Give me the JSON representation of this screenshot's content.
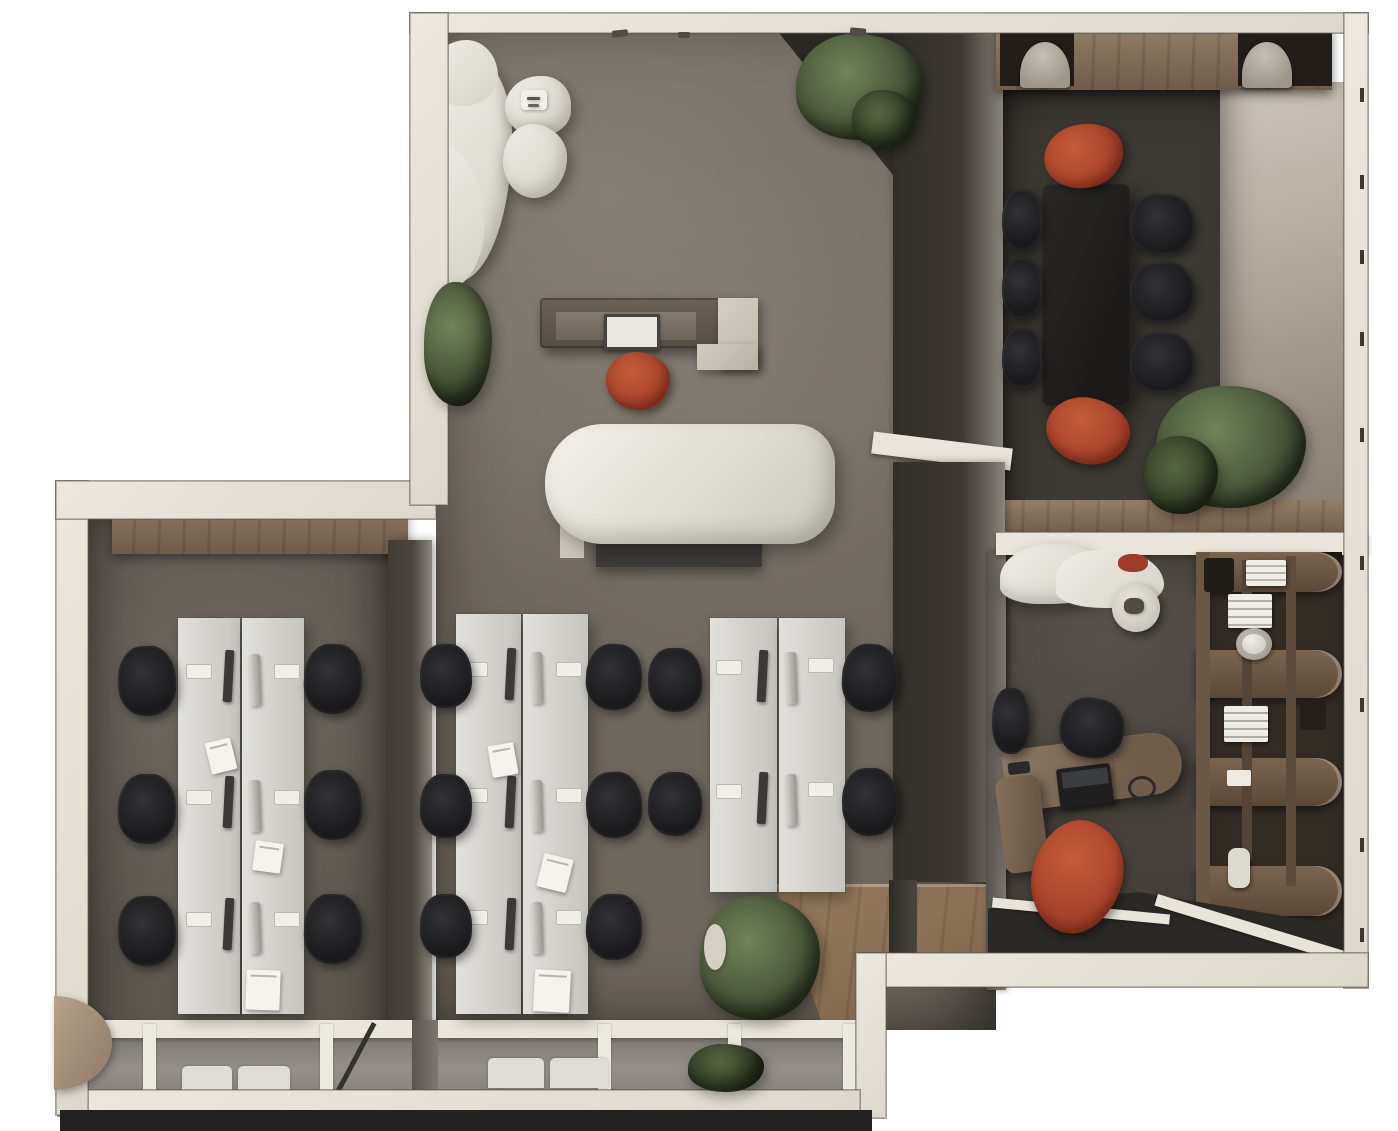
{
  "meta": {
    "description": "Top-down 3D architectural render of an office interior floor plan",
    "render_style": "photorealistic top view, no visible text or UI chrome"
  },
  "palette": {
    "outside": "#ffffff",
    "outerWall": "#e9e5da",
    "outerWallEdge": "#7b776f",
    "innerWallDark": "#38342e",
    "floorOpen": "#6e675e",
    "floorLeftRoom": "#5e5850",
    "floorMeeting": "#3d3933",
    "floorExec": "#46413a",
    "concreteWall": "#b4aa9c",
    "woodCredenza": "#8a7560",
    "woodFloor": "#8b7154",
    "deskWhite": "#d9d7d2",
    "chairBlack": "#1d1d1f",
    "chairRust": "#b0492f",
    "sofaCream": "#e5e2da",
    "conferenceTable": "#232221",
    "plantGreen": "#4c593a",
    "glassGray": "#8e8a83",
    "baseStrip": "#212121"
  },
  "rooms": [
    {
      "id": "reception-lounge",
      "label": "Reception and lounge",
      "furniture": [
        "organic-sofa",
        "pouf-side-tables",
        "reception-desk",
        "desktop-monitor",
        "rust-task-chair",
        "waiting-bench",
        "potted-plant",
        "coat-hooks"
      ]
    },
    {
      "id": "team-room-left",
      "label": "Enclosed team room",
      "workstations": 6,
      "furniture": [
        "double-desk-row",
        "task-chairs",
        "wood-credenza",
        "glazed-facade"
      ]
    },
    {
      "id": "open-office-center",
      "label": "Open plan office",
      "workstations": 10,
      "furniture": [
        "double-desk-rows",
        "task-chairs",
        "entry-wood-platform",
        "potted-plants"
      ]
    },
    {
      "id": "meeting-room",
      "label": "Meeting room",
      "seats": 8,
      "furniture": [
        "conference-table",
        "black-side-chairs",
        "rust-end-chairs",
        "wood-credenza",
        "barrel-chairs",
        "potted-plant",
        "concrete-feature-wall"
      ]
    },
    {
      "id": "executive-office",
      "label": "Executive office",
      "furniture": [
        "curved-sofa",
        "round-side-table",
        "executive-desk",
        "laptop",
        "executive-chair",
        "guest-chair",
        "rust-chair",
        "curved-bookshelf",
        "glazed-front"
      ]
    }
  ],
  "scene": {
    "desks": [
      [
        178,
        618,
        62,
        396
      ],
      [
        242,
        618,
        62,
        396
      ],
      [
        456,
        614,
        65,
        400
      ],
      [
        523,
        614,
        65,
        400
      ],
      [
        710,
        618,
        67,
        274
      ],
      [
        779,
        618,
        66,
        274
      ]
    ],
    "monitors_dark": [
      [
        224,
        650
      ],
      [
        224,
        776
      ],
      [
        224,
        898
      ],
      [
        506,
        648
      ],
      [
        506,
        776
      ],
      [
        506,
        898
      ],
      [
        758,
        650
      ],
      [
        758,
        772
      ]
    ],
    "monitors_light": [
      [
        250,
        654
      ],
      [
        250,
        780
      ],
      [
        250,
        902
      ],
      [
        532,
        652
      ],
      [
        532,
        780
      ],
      [
        532,
        902
      ],
      [
        786,
        652
      ],
      [
        786,
        774
      ]
    ],
    "keyboards": [
      [
        186,
        664
      ],
      [
        186,
        790
      ],
      [
        186,
        912
      ],
      [
        274,
        664
      ],
      [
        274,
        790
      ],
      [
        274,
        912
      ],
      [
        462,
        662
      ],
      [
        462,
        788
      ],
      [
        462,
        910
      ],
      [
        556,
        662
      ],
      [
        556,
        788
      ],
      [
        556,
        910
      ],
      [
        716,
        660
      ],
      [
        716,
        784
      ],
      [
        808,
        658
      ],
      [
        808,
        782
      ]
    ],
    "papers": [
      [
        208,
        740,
        26,
        32,
        -14
      ],
      [
        254,
        842,
        28,
        30,
        8
      ],
      [
        246,
        970,
        34,
        40,
        2
      ],
      [
        490,
        744,
        26,
        32,
        -10
      ],
      [
        540,
        856,
        30,
        34,
        14
      ],
      [
        534,
        970,
        36,
        42,
        3
      ]
    ],
    "chairs_black": [
      [
        118,
        646,
        58,
        70,
        -3
      ],
      [
        118,
        774,
        58,
        70,
        2
      ],
      [
        118,
        896,
        58,
        70,
        -2
      ],
      [
        304,
        644,
        58,
        70,
        3
      ],
      [
        304,
        770,
        58,
        70,
        -2
      ],
      [
        304,
        894,
        58,
        70,
        2
      ],
      [
        420,
        644,
        52,
        64,
        -2
      ],
      [
        420,
        774,
        52,
        64,
        2
      ],
      [
        420,
        894,
        52,
        64,
        0
      ],
      [
        586,
        644,
        56,
        66,
        3
      ],
      [
        586,
        772,
        56,
        66,
        -3
      ],
      [
        586,
        894,
        56,
        66,
        2
      ],
      [
        648,
        648,
        54,
        64,
        -2
      ],
      [
        648,
        772,
        54,
        64,
        2
      ],
      [
        842,
        644,
        56,
        68,
        3
      ],
      [
        842,
        768,
        56,
        68,
        -2
      ],
      [
        1002,
        190,
        40,
        60,
        0
      ],
      [
        1002,
        258,
        40,
        60,
        0
      ],
      [
        1002,
        328,
        40,
        60,
        0
      ],
      [
        1130,
        194,
        64,
        60,
        2
      ],
      [
        1130,
        262,
        64,
        60,
        -2
      ],
      [
        1130,
        332,
        64,
        60,
        2
      ],
      [
        1060,
        698,
        64,
        60,
        10
      ],
      [
        992,
        688,
        38,
        66,
        0
      ]
    ],
    "chairs_red": [
      [
        606,
        352,
        64,
        58,
        0
      ],
      [
        1044,
        124,
        80,
        64,
        -14
      ],
      [
        1046,
        398,
        84,
        66,
        10
      ],
      [
        1032,
        820,
        90,
        114,
        16
      ]
    ],
    "pots": [
      [
        1170,
        416,
        48,
        54
      ]
    ],
    "plants": [
      [
        424,
        282,
        68,
        124,
        0
      ],
      [
        796,
        34,
        128,
        106,
        0
      ],
      [
        852,
        90,
        64,
        58,
        1
      ],
      [
        1156,
        386,
        150,
        122,
        0
      ],
      [
        1144,
        436,
        74,
        78,
        1
      ],
      [
        700,
        896,
        120,
        124,
        0
      ],
      [
        688,
        1044,
        76,
        48,
        1
      ]
    ],
    "decor": [
      [
        521,
        90,
        26,
        20,
        "4px",
        "#f1efe8",
        "tray-decor"
      ],
      [
        527,
        97,
        13,
        3,
        "1px",
        "#5a564e",
        "tray-item"
      ],
      [
        528,
        104,
        11,
        3,
        "1px",
        "#6a655c",
        "tray-item"
      ],
      [
        704,
        924,
        22,
        46,
        "50%",
        "#d6d0c2",
        "planter-vase"
      ],
      [
        1124,
        598,
        20,
        16,
        "40%",
        "#514c44",
        "side-table-decor"
      ]
    ],
    "wall_hooks": [
      [
        612,
        30,
        16,
        7,
        -6
      ],
      [
        678,
        32,
        12,
        6,
        0
      ],
      [
        850,
        28,
        16,
        8,
        5
      ]
    ],
    "wall_ticks_y": [
      88,
      175,
      250,
      332,
      428,
      556,
      698,
      838,
      928
    ]
  }
}
